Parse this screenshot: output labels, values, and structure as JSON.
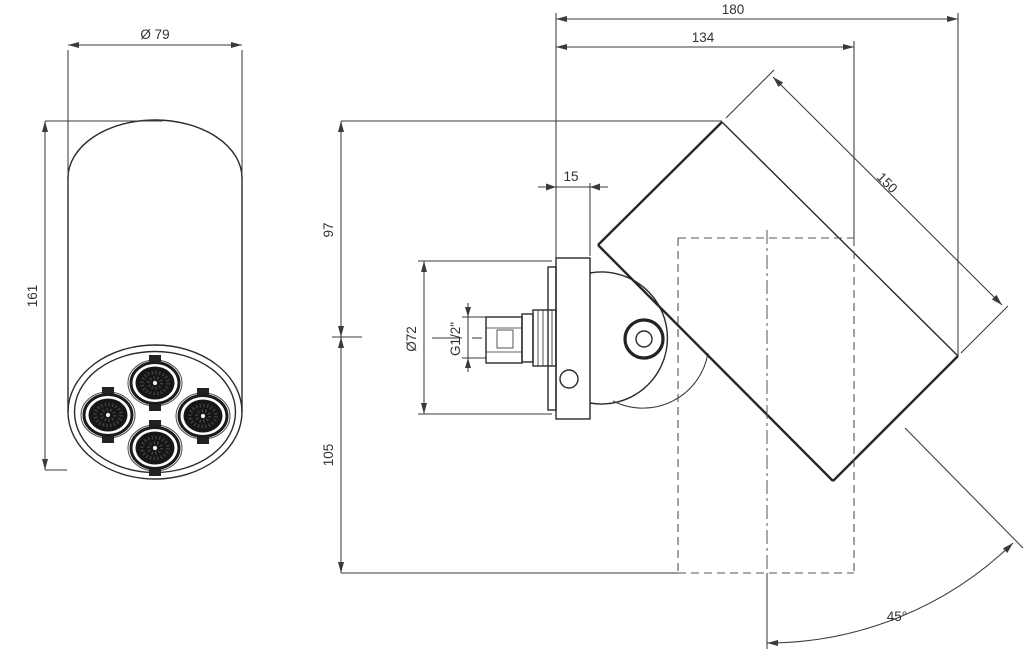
{
  "drawing": {
    "type": "technical-dimension-drawing",
    "subject": "wall-mounted adjustable shower head with 4 nozzles",
    "front_view": {
      "diameter": "Ø 79",
      "height": "161"
    },
    "side_view": {
      "overall_depth": "180",
      "head_depth": "134",
      "head_length": "150",
      "plate_thickness": "15",
      "above_axis": "97",
      "below_axis": "105",
      "escutcheon_diameter": "Ø72",
      "thread": "G1/2\"",
      "swivel_angle": "45°"
    },
    "colors": {
      "background": "#ffffff",
      "part_line": "#2b2b2b",
      "dimension_line": "#3a3a3a",
      "hidden_line": "#555555"
    }
  }
}
